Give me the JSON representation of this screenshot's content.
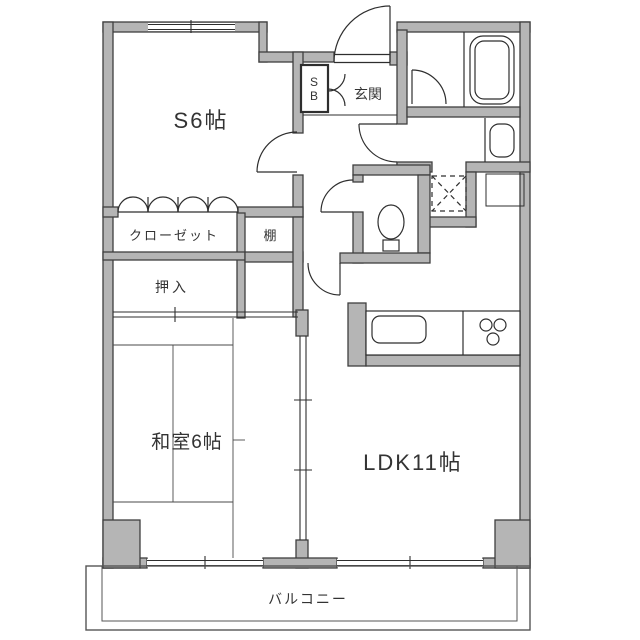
{
  "colors": {
    "background": "#ffffff",
    "wall_fill": "#b5b5b5",
    "wall_stroke": "#3f3f3f",
    "line": "#2e2e2e",
    "text": "#333333"
  },
  "plan": {
    "rooms": {
      "service_room": "S6帖",
      "entrance": "玄関",
      "shoe_box_line1": "S",
      "shoe_box_line2": "B",
      "closet": "クローゼット",
      "shelf": "棚",
      "futon_closet": "押入",
      "japanese_room": "和室6帖",
      "ldk": "LDK11帖",
      "balcony": "バルコニー"
    },
    "fixtures": {
      "bathtub": "bathtub-icon",
      "toilet": "toilet-icon",
      "kitchen_sink": "kitchen-sink-icon",
      "stove": "stove-burners-icon",
      "washing_machine_space": "washing-machine-space-icon",
      "vanity_sink": "vanity-sink-icon",
      "entrance_door": "entrance-door-swing-icon",
      "folding_closet_doors": "folding-doors-icon"
    }
  }
}
